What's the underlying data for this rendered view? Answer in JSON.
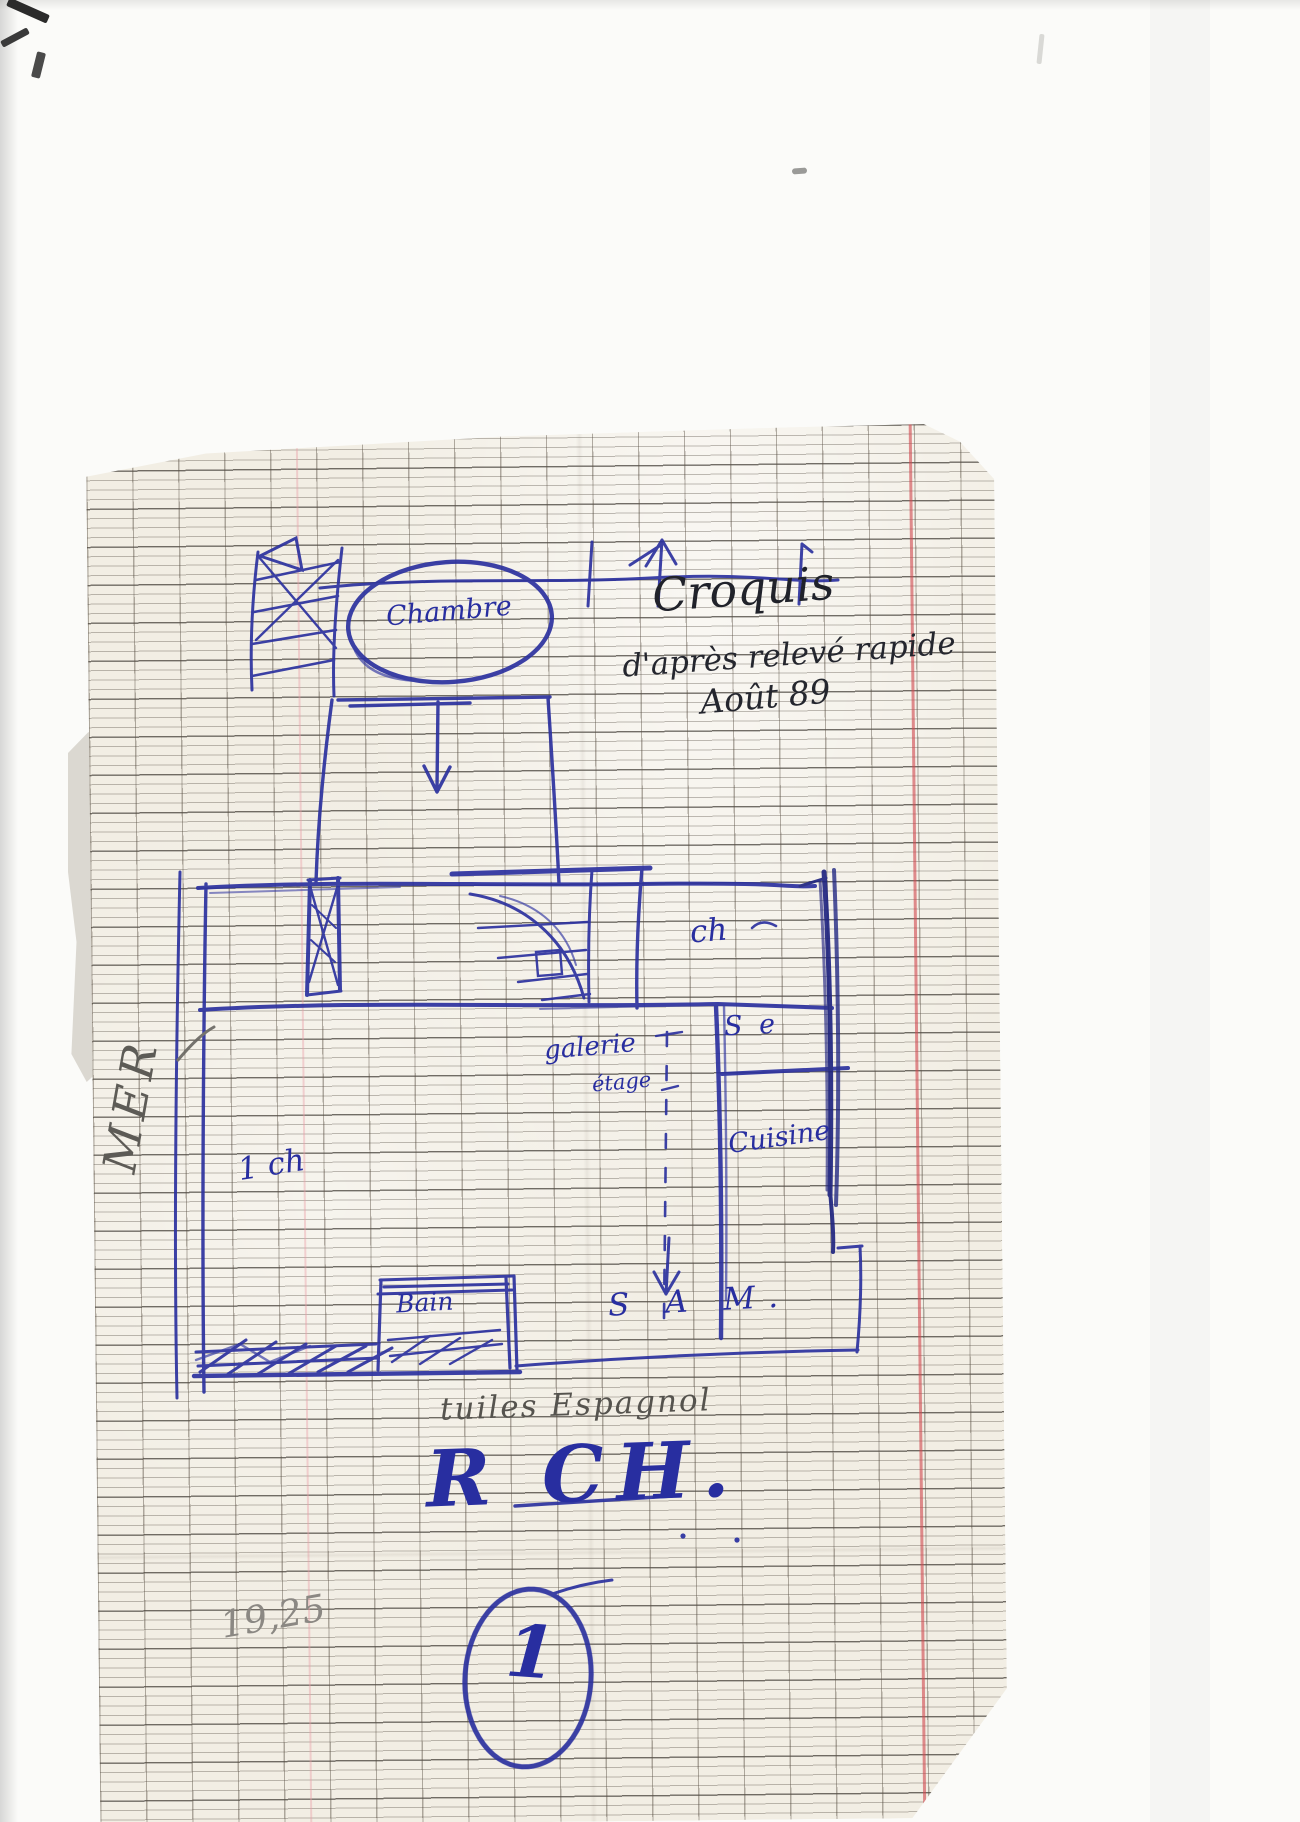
{
  "document": {
    "header_note": {
      "line1": "Croquis",
      "line2": "d'après relevé rapide",
      "line3": "Août 89"
    },
    "floor_plan": {
      "rooms": {
        "chambre": "Chambre",
        "ch": "ch",
        "salle_eau": "S e",
        "cuisine": "Cuisine",
        "galerie": "galerie",
        "etage": "étage",
        "un_ch": "1 ch",
        "bain": "Bain",
        "sam": "S A M."
      },
      "side_label": "MER"
    },
    "footer_notes": {
      "material": "tuiles Espagnol",
      "level": "R CH.",
      "measurement": "19,25",
      "page_number": "1"
    },
    "colors": {
      "ink_blue": "#282ea0",
      "pencil_gray": "#5f5d58",
      "margin_red": "#d04a50",
      "paper": "#f2eee4"
    }
  }
}
